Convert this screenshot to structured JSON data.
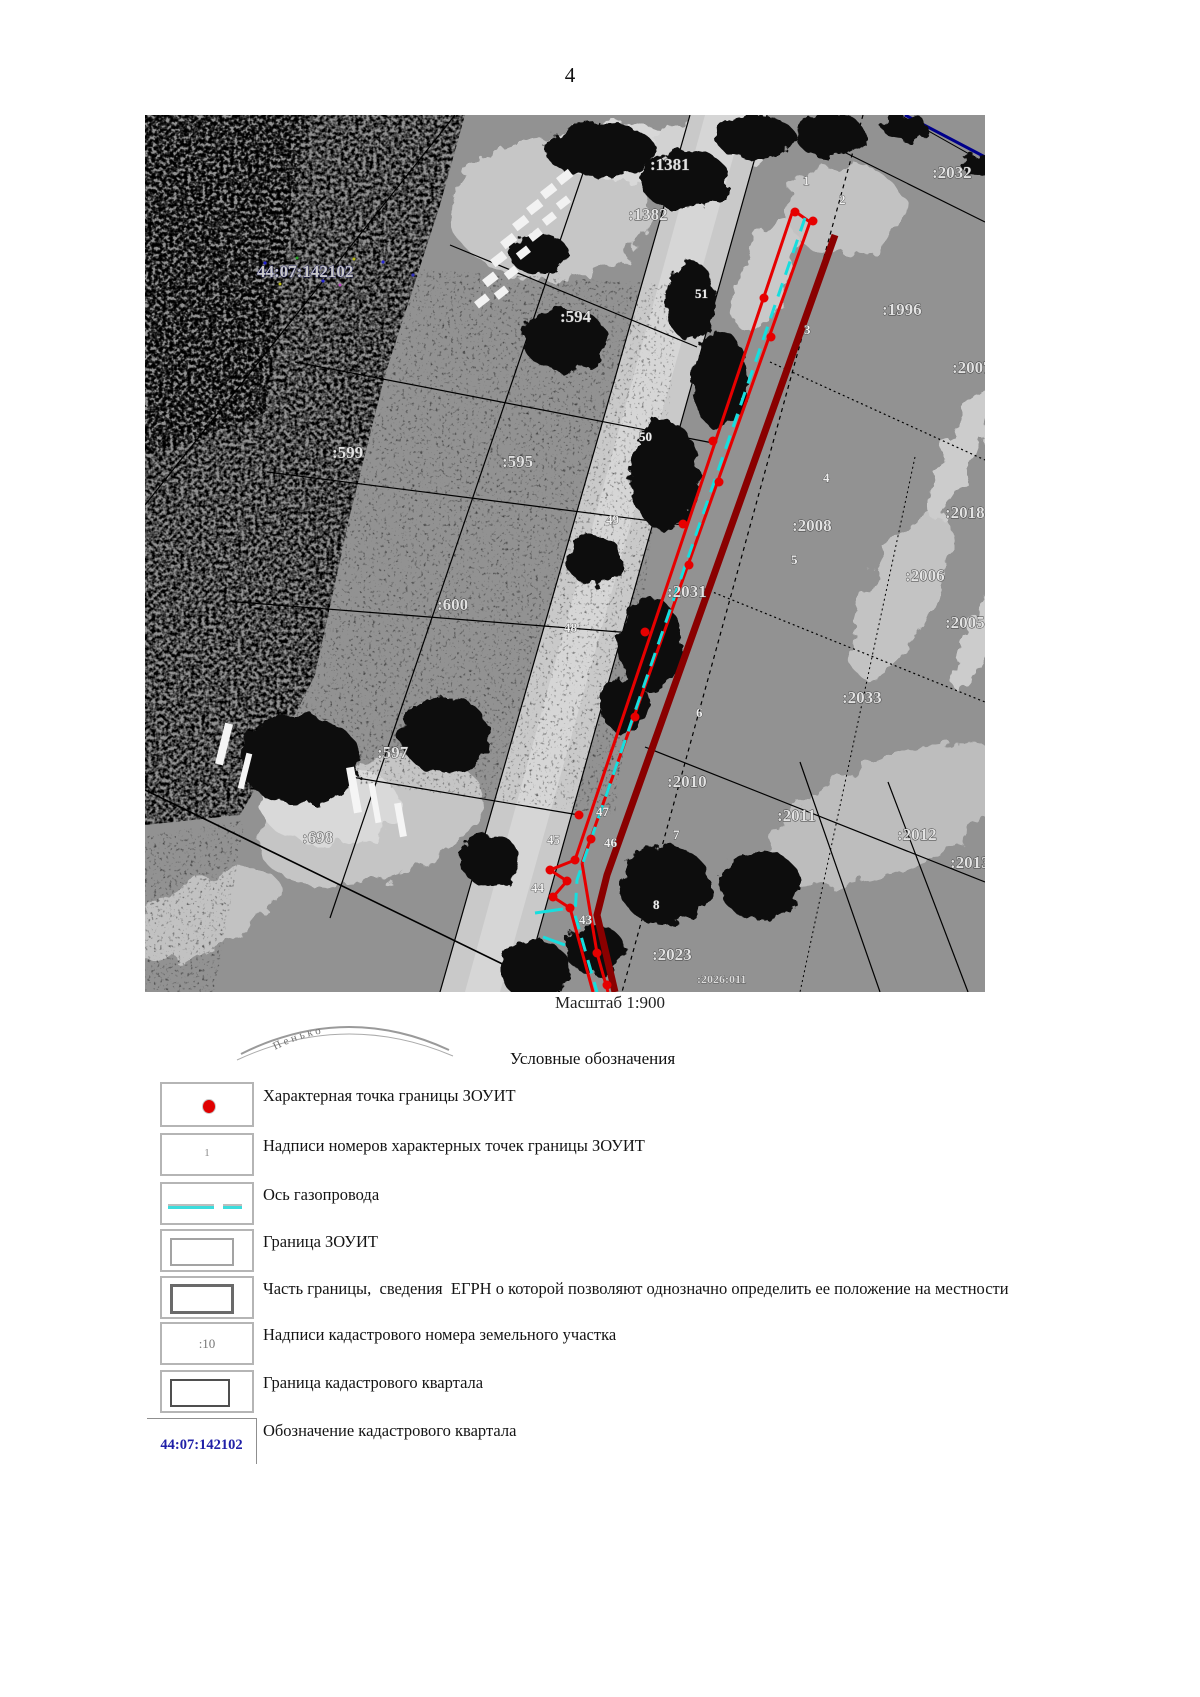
{
  "page": {
    "number": "4"
  },
  "map": {
    "caption": "Масштаб 1:900",
    "stamp_text": "Пенько",
    "quarter_label": "44:07:142102",
    "parcel_labels": [
      ":1381",
      ":1382",
      ":2032",
      ":594",
      ":1996",
      ":2007",
      ":599",
      ":595",
      ":2018",
      ":2008",
      ":2006",
      ":2005",
      ":2031",
      ":600",
      ":2033",
      ":597",
      ":2010",
      ":698",
      ":2011",
      ":2012",
      ":2013",
      ":2023",
      ":2026:011"
    ],
    "point_labels": [
      "1",
      "2",
      "3",
      "4",
      "5",
      "6",
      "7",
      "8",
      "51",
      "50",
      "49",
      "48",
      "47",
      "46",
      "45",
      "44",
      "43"
    ],
    "colors": {
      "boundary_red": "#e60000",
      "pipeline_cyan": "#16dede",
      "gas_maroon": "#8a0000",
      "quarter_navy": "#00008b",
      "road_gray": "#cdcdcd"
    }
  },
  "legend": {
    "title": "Условные обозначения",
    "items": [
      {
        "label": "Характерная точка границы ЗОУИТ",
        "symbol": "zouit-point"
      },
      {
        "label": "Надписи номеров характерных точек границы ЗОУИТ",
        "symbol": "point-number",
        "symbol_text": "1"
      },
      {
        "label": "Ось газопровода",
        "symbol": "gas-axis"
      },
      {
        "label": "Граница ЗОУИТ",
        "symbol": "zouit-boundary"
      },
      {
        "label": "Часть границы,  сведения  ЕГРН о которой позволяют однозначно определить ее положение на местности",
        "symbol": "egrn-boundary-part"
      },
      {
        "label": "Надписи кадастрового номера земельного участка",
        "symbol": "parcel-number",
        "symbol_text": ":10"
      },
      {
        "label": "Граница кадастрового квартала",
        "symbol": "quarter-boundary"
      },
      {
        "label": "Обозначение кадастрового квартала",
        "symbol": "quarter-designation",
        "symbol_text": "44:07:142102"
      }
    ]
  }
}
